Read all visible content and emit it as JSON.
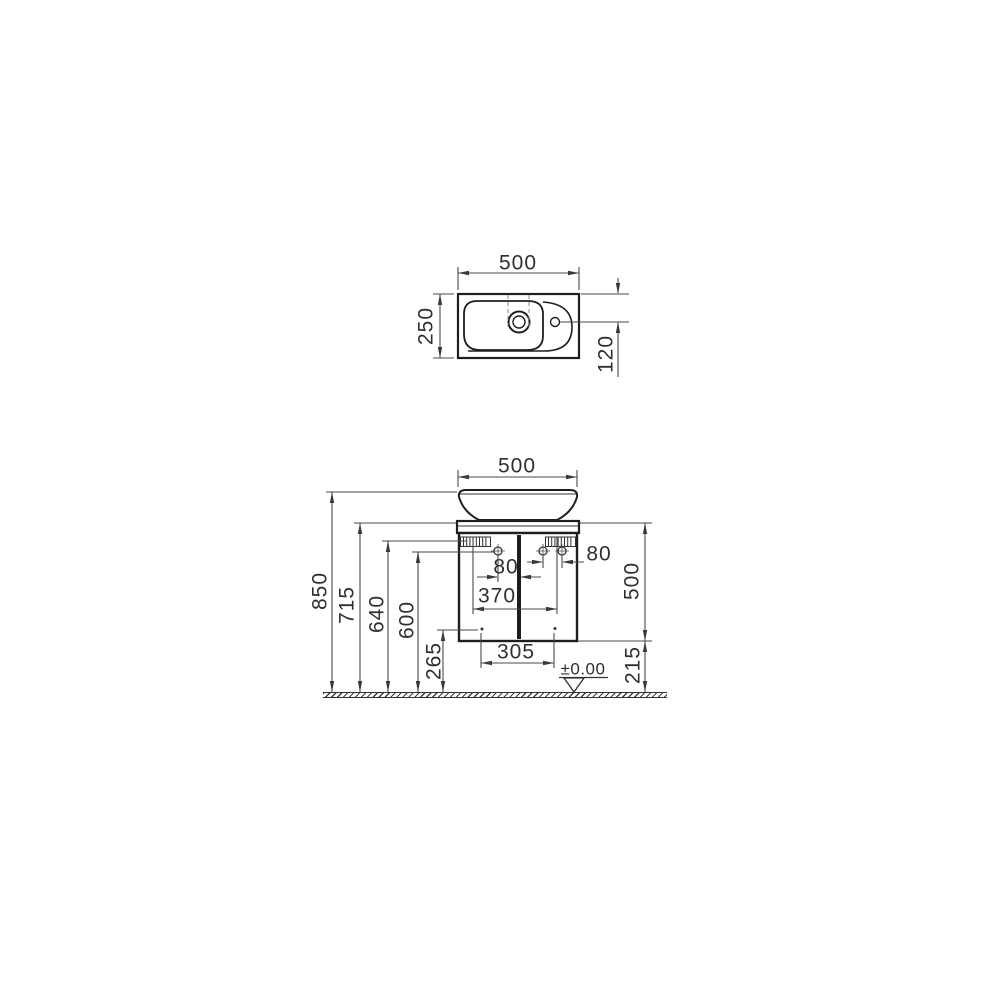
{
  "top_view": {
    "width": "500",
    "depth": "250",
    "tap_hole_offset": "120"
  },
  "front_view": {
    "width": "500",
    "overall_height": "850",
    "worktop_height": "715",
    "bracket_height": "640",
    "mount_hole_height": "600",
    "handle_height": "265",
    "left_hole_offset": "80",
    "right_hole_spacing": "80",
    "bracket_spacing": "370",
    "handle_spacing": "305",
    "cabinet_height": "500",
    "floor_clearance": "215",
    "datum_level": "±0.00"
  }
}
